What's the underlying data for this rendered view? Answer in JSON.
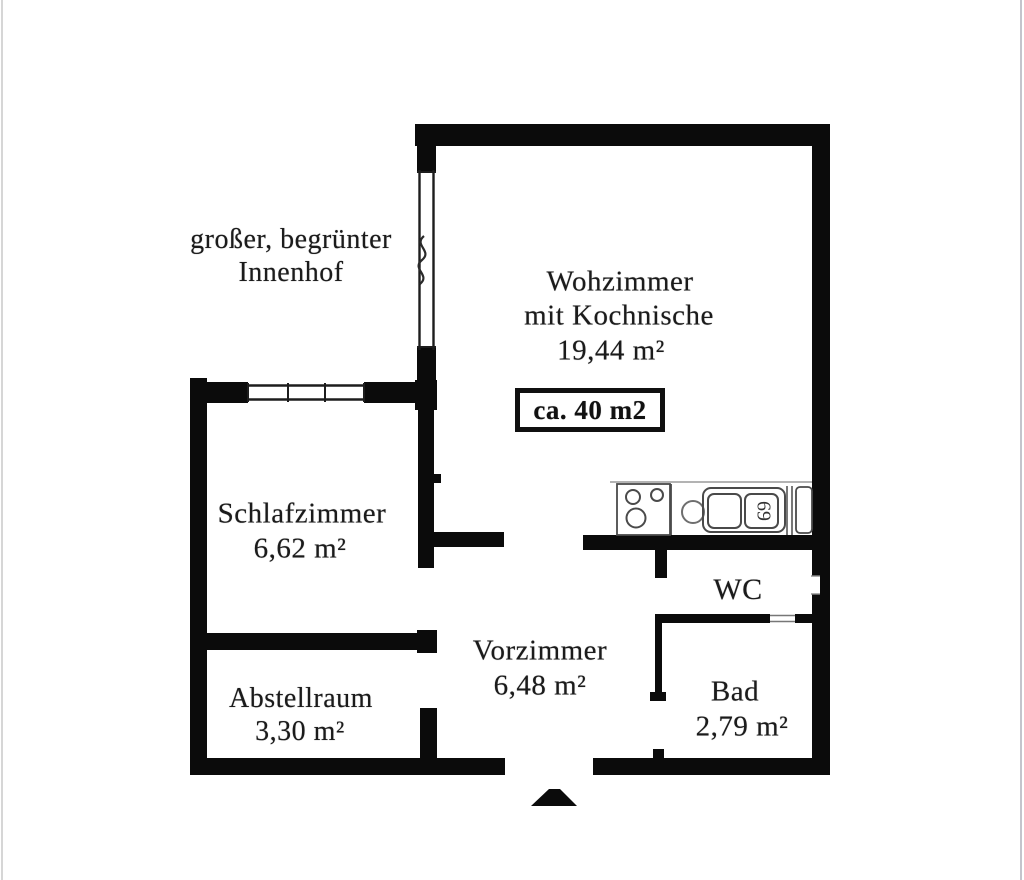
{
  "floorplan": {
    "outside": {
      "line1": "großer, begrünter",
      "line2": "Innenhof"
    },
    "rooms": {
      "wohnzimmer": {
        "line1": "Wohzimmer",
        "line2": "mit Kochnische",
        "area": "19,44 m²"
      },
      "schlafzimmer": {
        "name": "Schlafzimmer",
        "area": "6,62 m²"
      },
      "vorzimmer": {
        "name": "Vorzimmer",
        "area": "6,48 m²"
      },
      "abstellraum": {
        "name": "Abstellraum",
        "area": "3,30 m²"
      },
      "wc": {
        "name": "WC"
      },
      "bad": {
        "name": "Bad",
        "area": "2,79 m²"
      }
    },
    "size_box": {
      "label": "ca. 40 m2"
    },
    "kitchen": {
      "sink_marking": "69"
    },
    "colors": {
      "wall": "#0b0b0b",
      "text": "#1b1b1b",
      "background": "#ffffff"
    }
  }
}
